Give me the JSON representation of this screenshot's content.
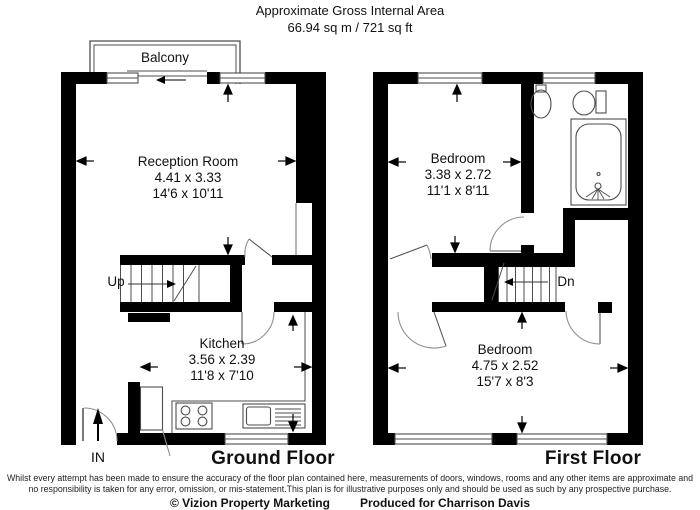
{
  "header": {
    "title": "Approximate Gross Internal Area",
    "area": "66.94 sq m / 721 sq ft"
  },
  "ground_floor": {
    "label": "Ground Floor",
    "balcony": "Balcony",
    "stairs": "Up",
    "entrance": "IN",
    "reception": {
      "name": "Reception Room",
      "metric": "4.41 x 3.33",
      "imperial": "14'6 x 10'11"
    },
    "kitchen": {
      "name": "Kitchen",
      "metric": "3.56 x 2.39",
      "imperial": "11'8 x 7'10"
    }
  },
  "first_floor": {
    "label": "First Floor",
    "stairs": "Dn",
    "bedroom_front": {
      "name": "Bedroom",
      "metric": "3.38 x 2.72",
      "imperial": "11'1 x 8'11"
    },
    "bedroom_back": {
      "name": "Bedroom",
      "metric": "4.75 x 2.52",
      "imperial": "15'7 x 8'3"
    }
  },
  "footer": {
    "line1": "Whilst every attempt has been made to ensure the accuracy of the floor plan contained here, measurements of doors, windows, rooms and any other items are approximate and",
    "line2": "no responsibility is taken for any error, omission, or mis-statement.This plan is for illustrative purposes only and should be used as such by any prospective purchase.",
    "copyright": "© Vizion Property Marketing",
    "produced": "Produced for Charrison Davis"
  },
  "colors": {
    "wall": "#000000",
    "thin_line": "#4d4d4d",
    "arc": "#8f8f8f",
    "background": "#ffffff"
  }
}
